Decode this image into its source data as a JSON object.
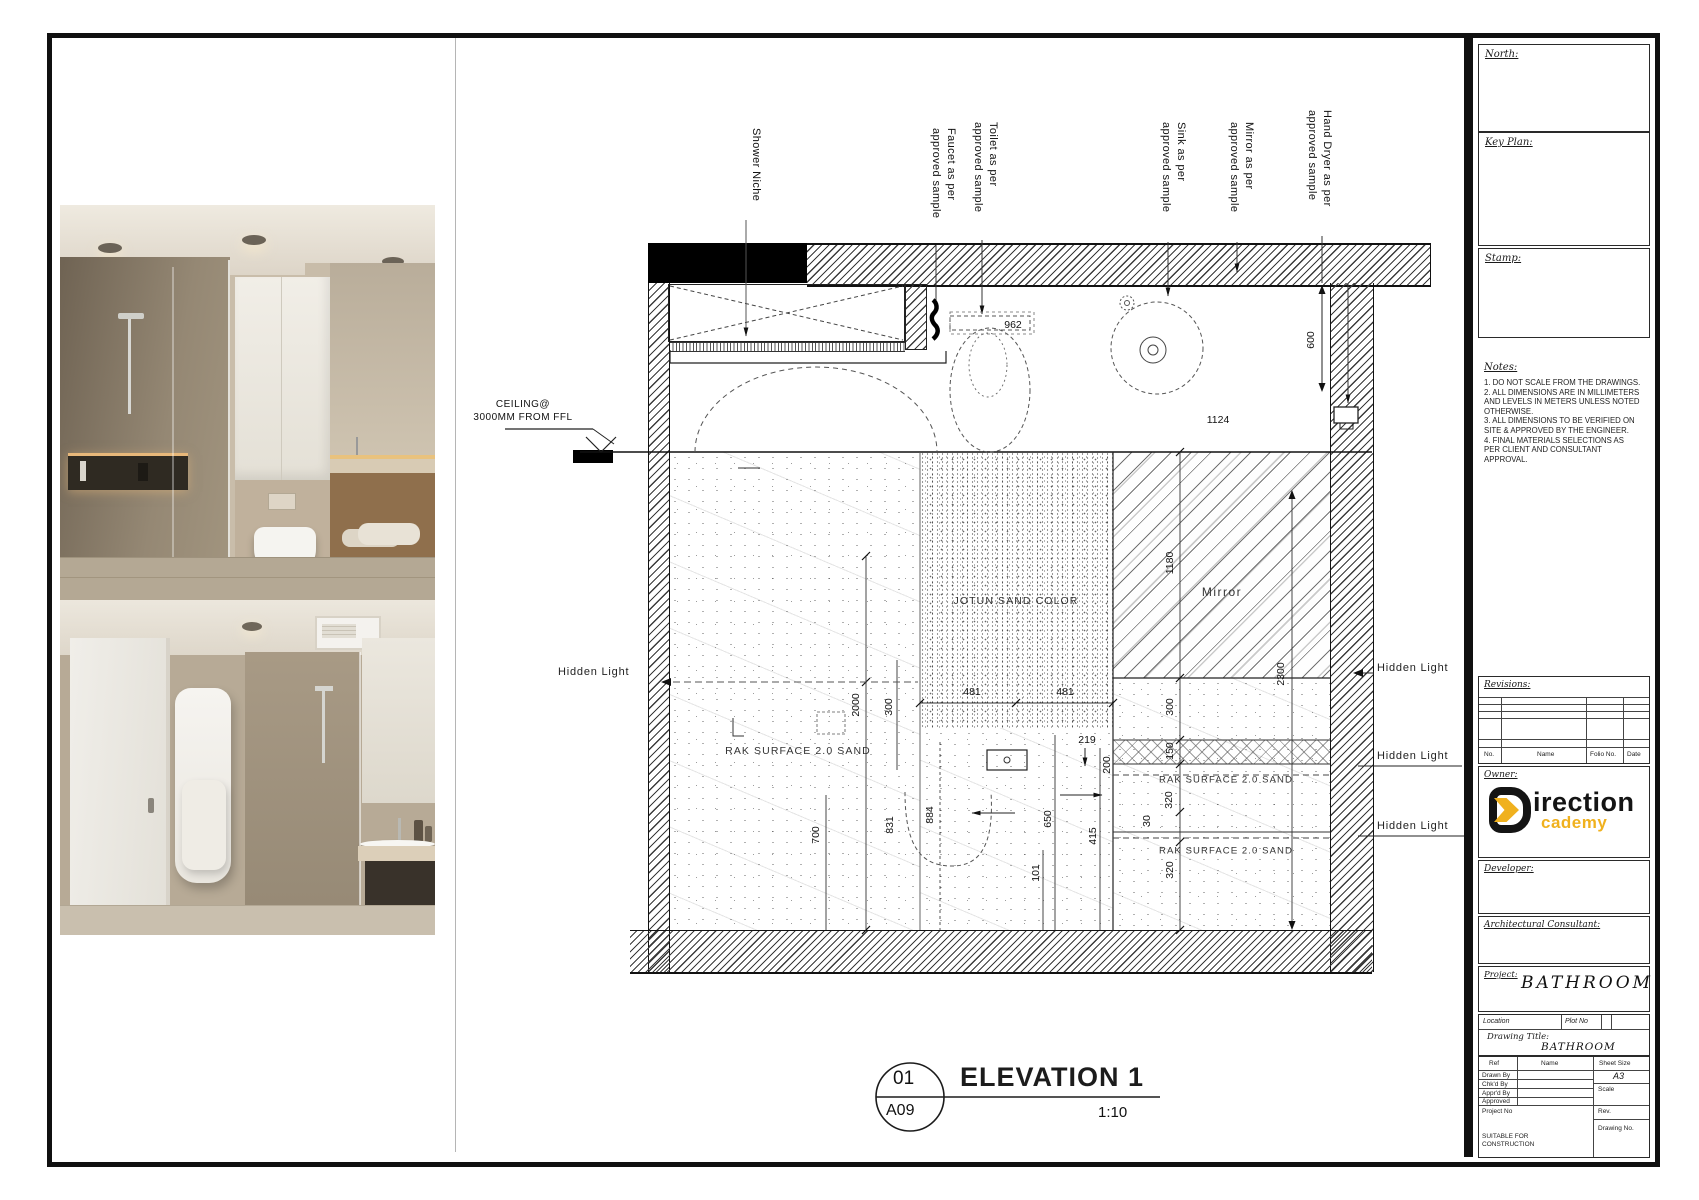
{
  "plan": {
    "labels": {
      "shower_niche": "Shower Niche",
      "faucet": "Faucet as per\napproved sample",
      "toilet": "Toilet as per\napproved sample",
      "sink": "Sink as per\napproved sample",
      "mirror": "Mirror as per\napproved sample",
      "hand_dryer": "Hand Dryer as per\napproved sample",
      "ceiling_note": "CEILING@\n3000MM FROM FFL"
    },
    "dims": {
      "d962": "962",
      "d1124": "1124",
      "d600": "600"
    }
  },
  "elevation": {
    "materials": {
      "jotun": "JOTUN SAND COLOR",
      "rak": "RAK SURFACE 2.0 SAND",
      "mirror": "Mirror",
      "hidden_light": "Hidden Light"
    },
    "dims": {
      "d1180": "1180",
      "d2300": "2300",
      "d481a": "481",
      "d481b": "481",
      "d2000": "2000",
      "d300a": "300",
      "d700": "700",
      "d831": "831",
      "d884": "884",
      "d300b": "300",
      "d150": "150",
      "d320a": "320",
      "d30": "30",
      "d320b": "320",
      "d219": "219",
      "d200": "200",
      "d650": "650",
      "d415": "415",
      "d101": "101"
    }
  },
  "titlebar": {
    "detail_no": "01",
    "sheet_ref": "A09",
    "title": "ELEVATION 1",
    "scale": "1:10"
  },
  "panel": {
    "north": "North:",
    "key_plan": "Key Plan:",
    "stamp": "Stamp:",
    "notes_title": "Notes:",
    "notes": {
      "n1": "1. DO NOT SCALE FROM THE DRAWINGS.",
      "n2": "2. ALL DIMENSIONS ARE IN MILLIMETERS AND LEVELS IN METERS UNLESS NOTED OTHERWISE.",
      "n3": "3. ALL DIMENSIONS TO BE VERIFIED ON SITE & APPROVED BY THE ENGINEER.",
      "n4": "4. FINAL MATERIALS SELECTIONS AS PER CLIENT AND CONSULTANT APPROVAL."
    },
    "revisions": {
      "title": "Revisions:",
      "no": "No.",
      "name": "Name",
      "folio": "Folio No.",
      "date": "Date"
    },
    "owner_label": "Owner:",
    "logo": {
      "word1": "irection",
      "word2": "cademy",
      "black": "#141414",
      "yellow": "#f0b11e"
    },
    "developer_label": "Developer:",
    "consultant_label": "Architectural Consultant:",
    "project_label": "Project:",
    "project_value": "BATHROOM",
    "location_label": "Location",
    "plot_label": "Plot No",
    "drawing_title_label": "Drawing Title:",
    "drawing_title_value": "BATHROOM",
    "table": {
      "ref": "Ref",
      "name": "Name",
      "sheet_size": "Sheet Size",
      "sheet_size_value": "A3",
      "drawn": "Drawn By",
      "chkd": "Chk'd By",
      "apprd": "Appr'd By",
      "approved": "Approved",
      "scale": "Scale",
      "project_no": "Project No",
      "rev": "Rev.",
      "drawing_no": "Drawing No.",
      "suitable": "SUITABLE FOR CONSTRUCTION"
    }
  }
}
